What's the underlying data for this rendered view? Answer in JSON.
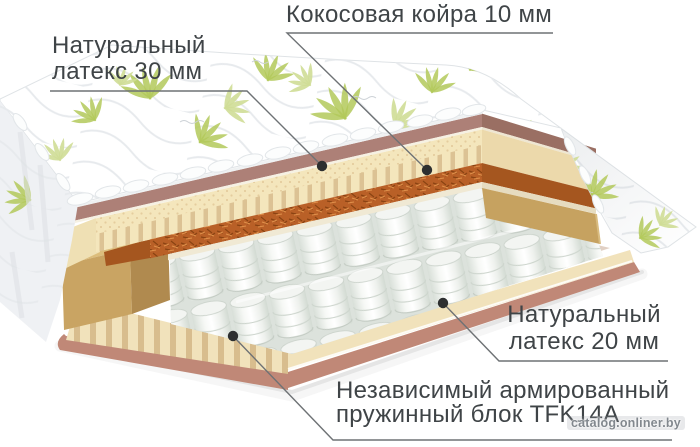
{
  "labels": {
    "latex_top": {
      "line1": "Натуральный",
      "line2": "латекс 30 мм"
    },
    "coir": {
      "text": "Кокосовая койра 10 мм"
    },
    "latex_bottom": {
      "line1": "Натуральный",
      "line2": "латекс 20 мм"
    },
    "springs": {
      "line1": "Независимый армированный",
      "line2": "пружинный блок TFK14A"
    }
  },
  "watermark": {
    "text": "catalog.onliner.by"
  },
  "palette": {
    "cover_white": "#ffffff",
    "quilt_line": "#e7eaed",
    "leaf_green": "#b3c95b",
    "leaf_green_light": "#cfdd96",
    "cover_underside": "#ad8077",
    "latex": "#f4e6bc",
    "latex_shadow": "#dcc294",
    "coir": "#b96027",
    "spring_white": "#f6f8f5",
    "base_latex": "#f1e2bb",
    "base_cover": "#c08877",
    "foam_block": "#c9a463",
    "label_text": "#3f4447",
    "callout_line": "#6e7275",
    "watermark_text": "#82888e"
  }
}
